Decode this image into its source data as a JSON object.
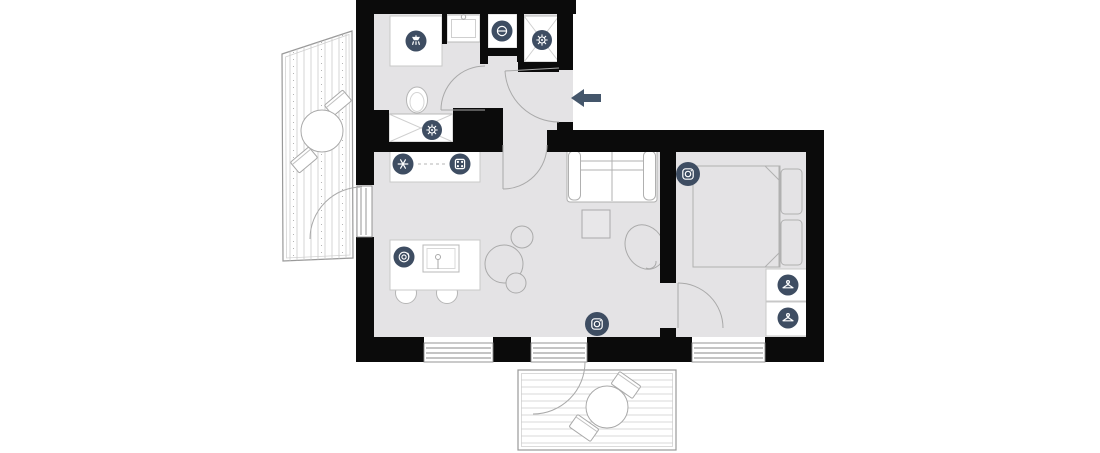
{
  "colors": {
    "wall": "#0b0b0b",
    "floor": "#e4e3e5",
    "badge": "#3e4d62",
    "badge_glyph": "#ffffff",
    "entrance_arrow": "#44566b",
    "fixture_fill": "#ffffff"
  },
  "icons": [
    {
      "name": "shower-icon",
      "meaning": "shower"
    },
    {
      "name": "laundry-machine-icon",
      "meaning": "washing machine (circle with door line)"
    },
    {
      "name": "gear-shaft-icon",
      "meaning": "utility / boiler shaft"
    },
    {
      "name": "gear-unit-icon",
      "meaning": "utility unit"
    },
    {
      "name": "fridge-snowflake-icon",
      "meaning": "refrigerator / freezer"
    },
    {
      "name": "stove-icon",
      "meaning": "cooktop with 4 burners"
    },
    {
      "name": "dishwasher-icon",
      "meaning": "dishwasher / plates"
    },
    {
      "name": "tv-living-icon",
      "meaning": "TV / media"
    },
    {
      "name": "tv-bedroom-icon",
      "meaning": "TV / media"
    },
    {
      "name": "hanger-upper-icon",
      "meaning": "wardrobe"
    },
    {
      "name": "hanger-lower-icon",
      "meaning": "wardrobe"
    }
  ],
  "entrance": {
    "symbol": "left-arrow"
  }
}
